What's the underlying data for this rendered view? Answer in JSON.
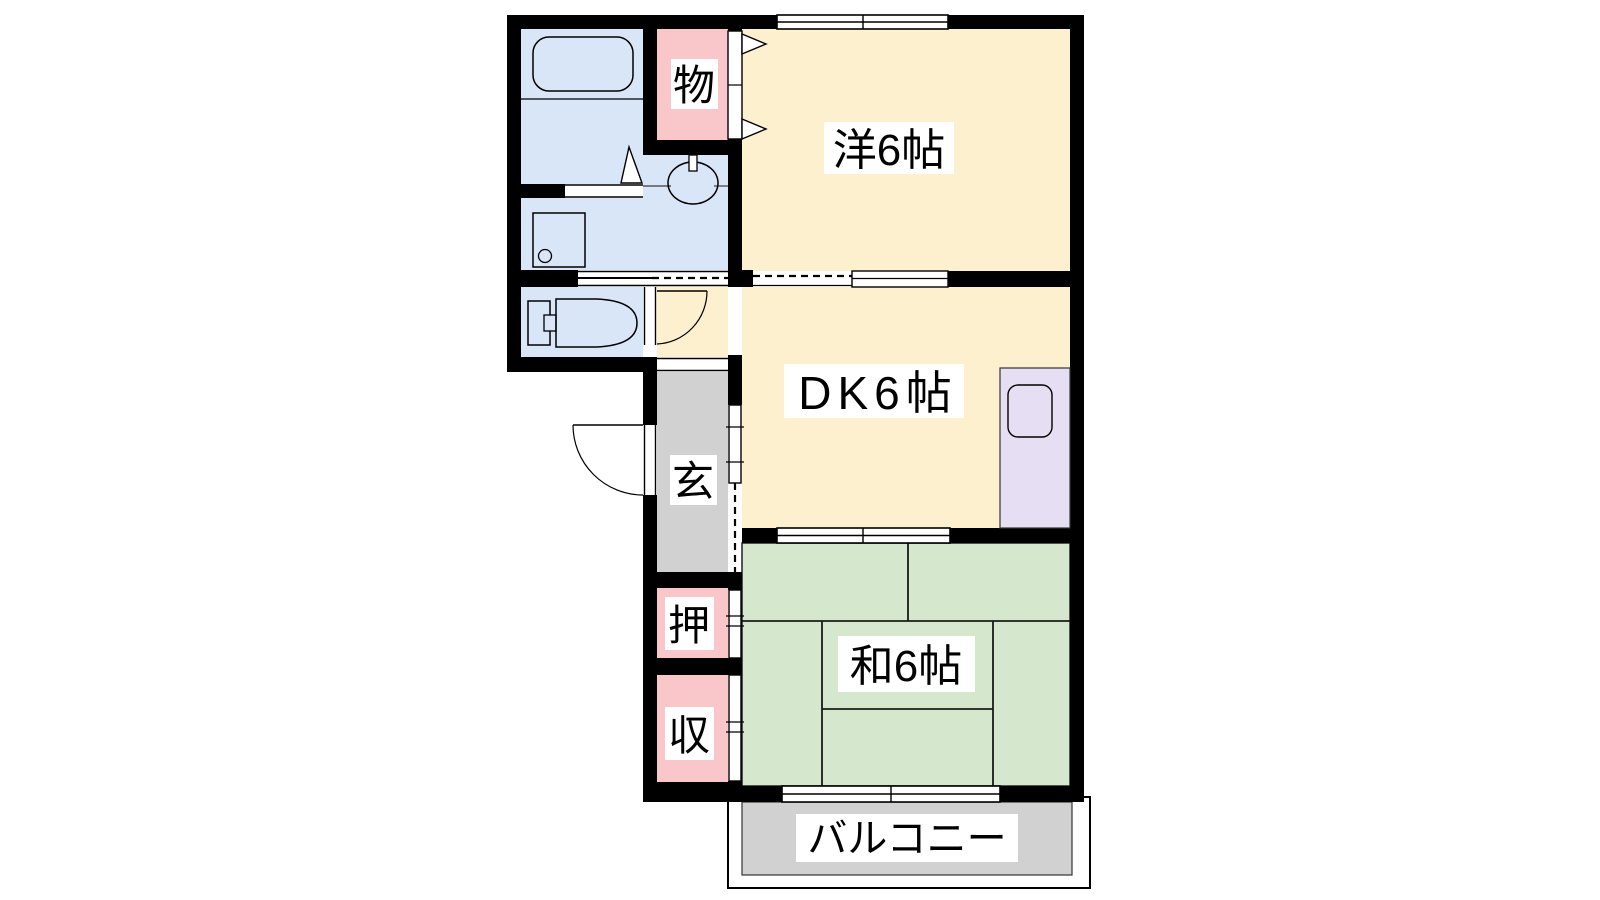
{
  "floorplan": {
    "type": "apartment-floor-plan-1DK-style",
    "wall_color": "#000000",
    "rooms": {
      "western_room": {
        "label": "洋6帖",
        "color": "#fdf0cf"
      },
      "dining_kitchen": {
        "label": "DK6帖",
        "color": "#fdf0cf"
      },
      "japanese_room": {
        "label": "和6帖",
        "color": "#d5e8cd"
      },
      "balcony": {
        "label": "バルコニー",
        "color": "#d1d1d1"
      },
      "entrance": {
        "label": "玄",
        "color": "#d1d1d1"
      },
      "storage_closet": {
        "label": "物",
        "color": "#f9c6c9"
      },
      "oshiire_upper": {
        "label": "押",
        "color": "#f9c6c9"
      },
      "oshiire_lower": {
        "label": "収",
        "color": "#f9c6c9"
      },
      "bathroom": {
        "color": "#d9e6f7"
      },
      "washroom": {
        "color": "#d9e6f7"
      },
      "toilet_room": {
        "color": "#d9e6f7"
      },
      "hall": {
        "color": "#fdf0cf"
      },
      "kitchen_unit": {
        "color": "#e6def2"
      }
    },
    "label_background": "#ffffff"
  }
}
